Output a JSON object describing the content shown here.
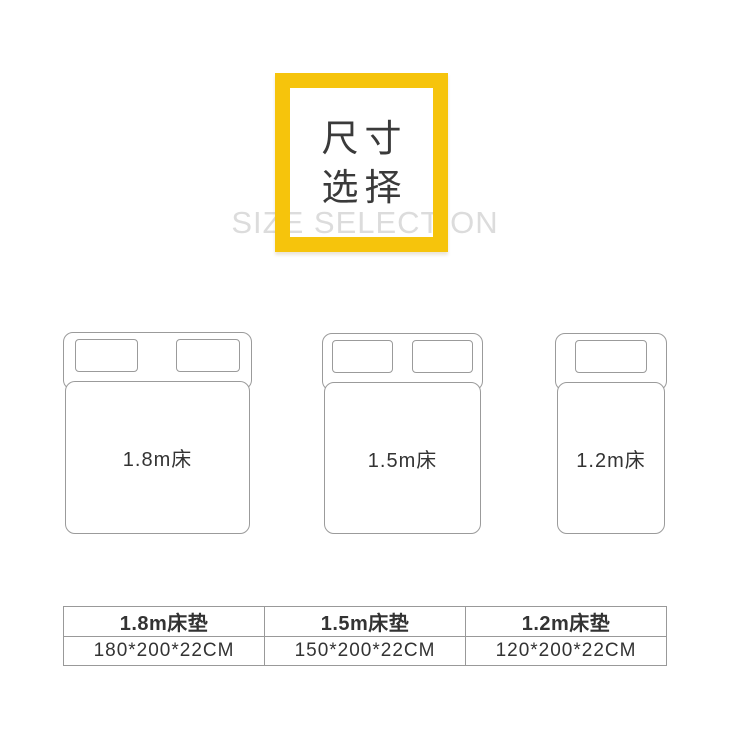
{
  "header": {
    "title_line1": "尺寸",
    "title_line2": "选择",
    "subtitle_en": "SIZE SELECTION"
  },
  "beds": [
    {
      "label": "1.8m床",
      "pillows": 2
    },
    {
      "label": "1.5m床",
      "pillows": 2
    },
    {
      "label": "1.2m床",
      "pillows": 1
    }
  ],
  "table": {
    "columns": [
      {
        "name": "1.8m床垫",
        "size": "180*200*22CM"
      },
      {
        "name": "1.5m床垫",
        "size": "150*200*22CM"
      },
      {
        "name": "1.2m床垫",
        "size": "120*200*22CM"
      }
    ]
  },
  "colors": {
    "accent_yellow": "#F6C40C",
    "line_gray": "#9B9B9B",
    "table_border_gray": "#999999",
    "text_dark": "#333333",
    "title_text": "#3A3A3A",
    "subtitle_light_gray": "#DCDCDC",
    "background": "#FFFFFF"
  }
}
